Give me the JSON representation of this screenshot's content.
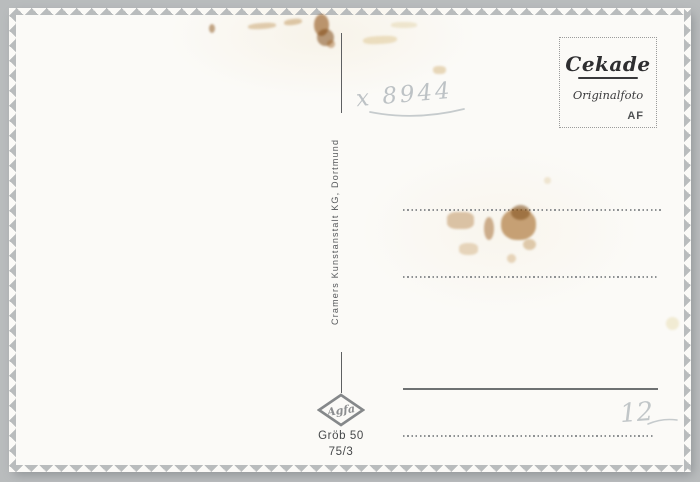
{
  "postcard": {
    "publisher_vertical": "Cramers Kunstanstalt KG, Dortmund",
    "stamp_box": {
      "brand": "Cekade",
      "subtitle": "Originalfoto",
      "code": "AF"
    },
    "film_logo": "Agfa",
    "caption_line1": "Gröb 50",
    "caption_line2": "75/3",
    "handwriting_top": "x 8944",
    "handwriting_price": "12",
    "colors": {
      "background": "#b9bcbd",
      "card": "#fbfaf7",
      "print_ink": "#55575a",
      "stain_rust": "#94591e",
      "pencil": "#bdc2c5"
    }
  }
}
